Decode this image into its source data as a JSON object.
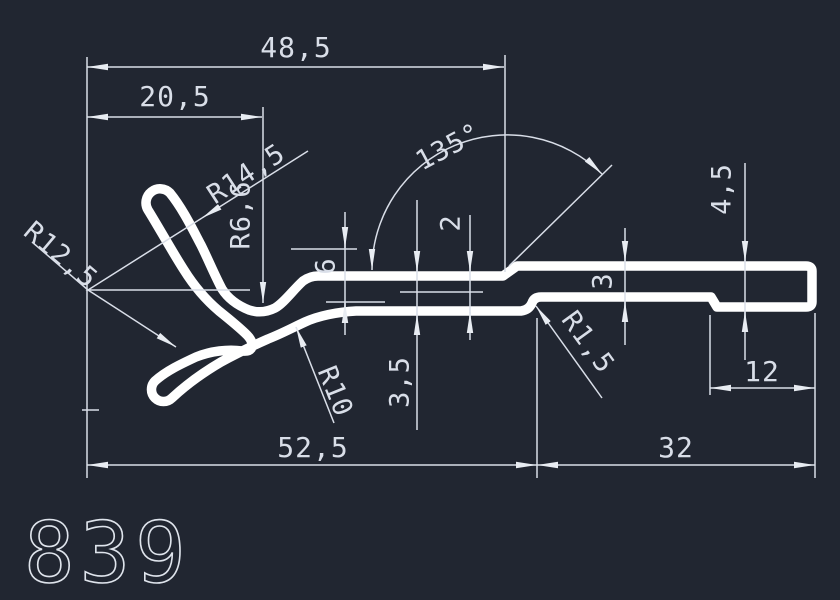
{
  "title": "Aluminium profile cross-section drawing",
  "profile_number": "839",
  "colors": {
    "background": "#212631",
    "line": "#d9dee8",
    "profile": "#ffffff"
  },
  "dims": {
    "overall_width": "48,5",
    "left_width": "20,5",
    "bottom_left_width": "52,5",
    "bottom_right_width": "32",
    "end_length": "12",
    "angle": "135°",
    "step_height": "6",
    "wall_thickness": "3,5",
    "step_depth": "2",
    "mid_thickness": "3",
    "end_thickness": "4,5",
    "radius_upper_outer": "R14,5",
    "radius_throat": "R6,6",
    "radius_lower_outer": "R12,5",
    "radius_neck": "R10",
    "radius_step": "R1,5"
  }
}
